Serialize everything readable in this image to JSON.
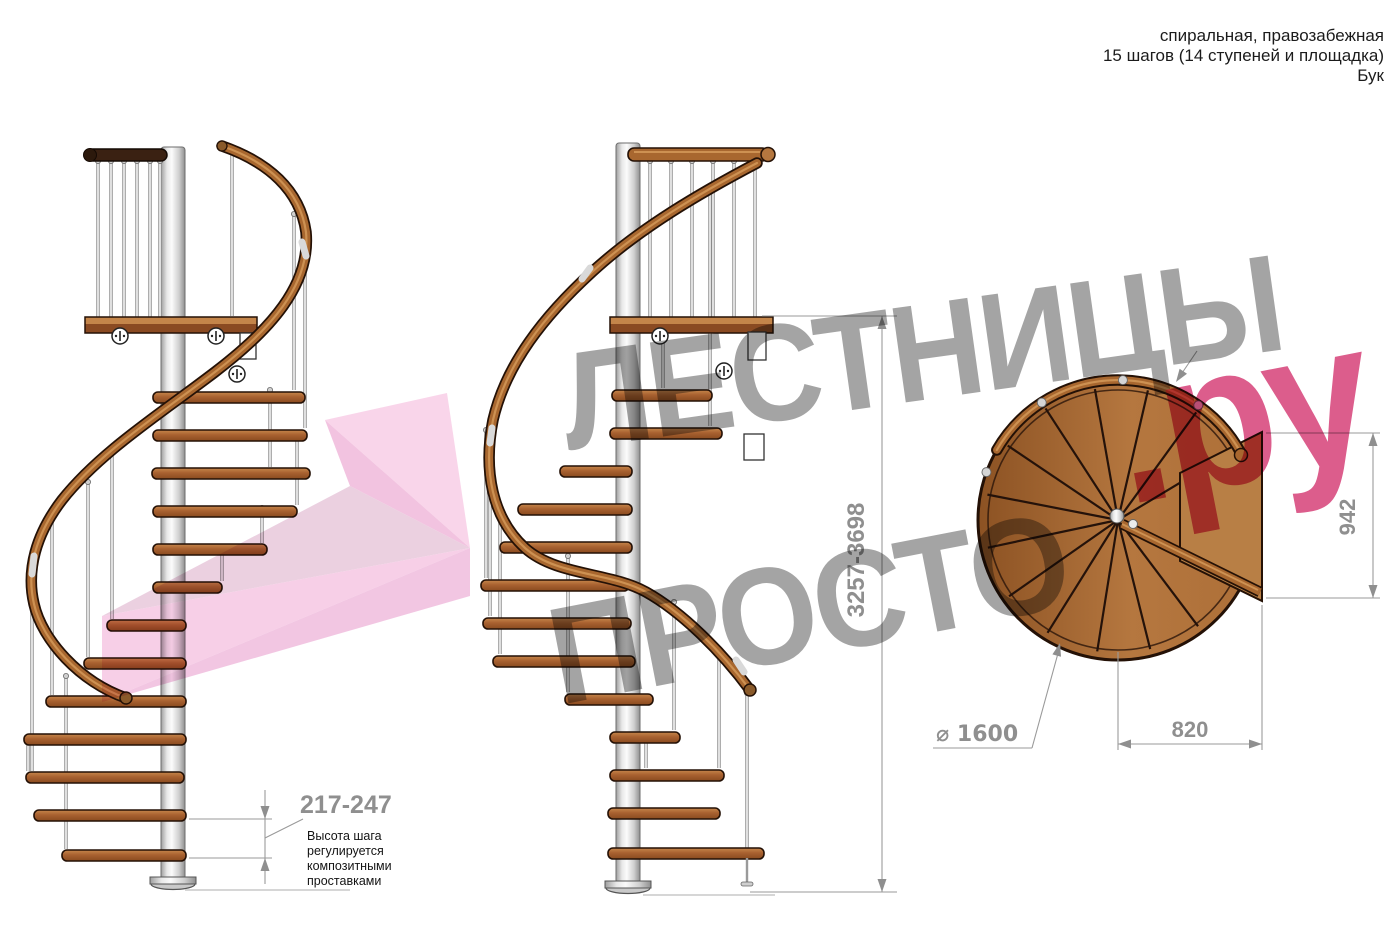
{
  "title_block": {
    "line1": "спиральная, правозабежная",
    "line2": "15 шагов (14 ступеней и площадка)",
    "line3": "Бук"
  },
  "watermark": {
    "word1": "ЛЕСТНИЦЫ",
    "word2": "ПРОСТО",
    "suffix": ".ру"
  },
  "annotations": {
    "total_height": "3257-3698",
    "step_height": "217-247",
    "step_note_line1": "Высота шага",
    "step_note_line2": "регулируется",
    "step_note_line3": "композитными",
    "step_note_line4": "проставками",
    "plan_depth": "942",
    "plan_width": "820",
    "diameter_label": "⌀ 1600"
  },
  "colors": {
    "wood": "#a8672f",
    "wood_dark": "#3a2112",
    "tread_face": "#a35a29",
    "metal": "#d9d9d9",
    "outline": "#241106",
    "dimension_gray": "#8f8f8f",
    "watermark_gray": "#9c9c9c",
    "watermark_pink": "#d94f82",
    "arrow_pink": "#f2b9dc",
    "background": "#ffffff"
  }
}
